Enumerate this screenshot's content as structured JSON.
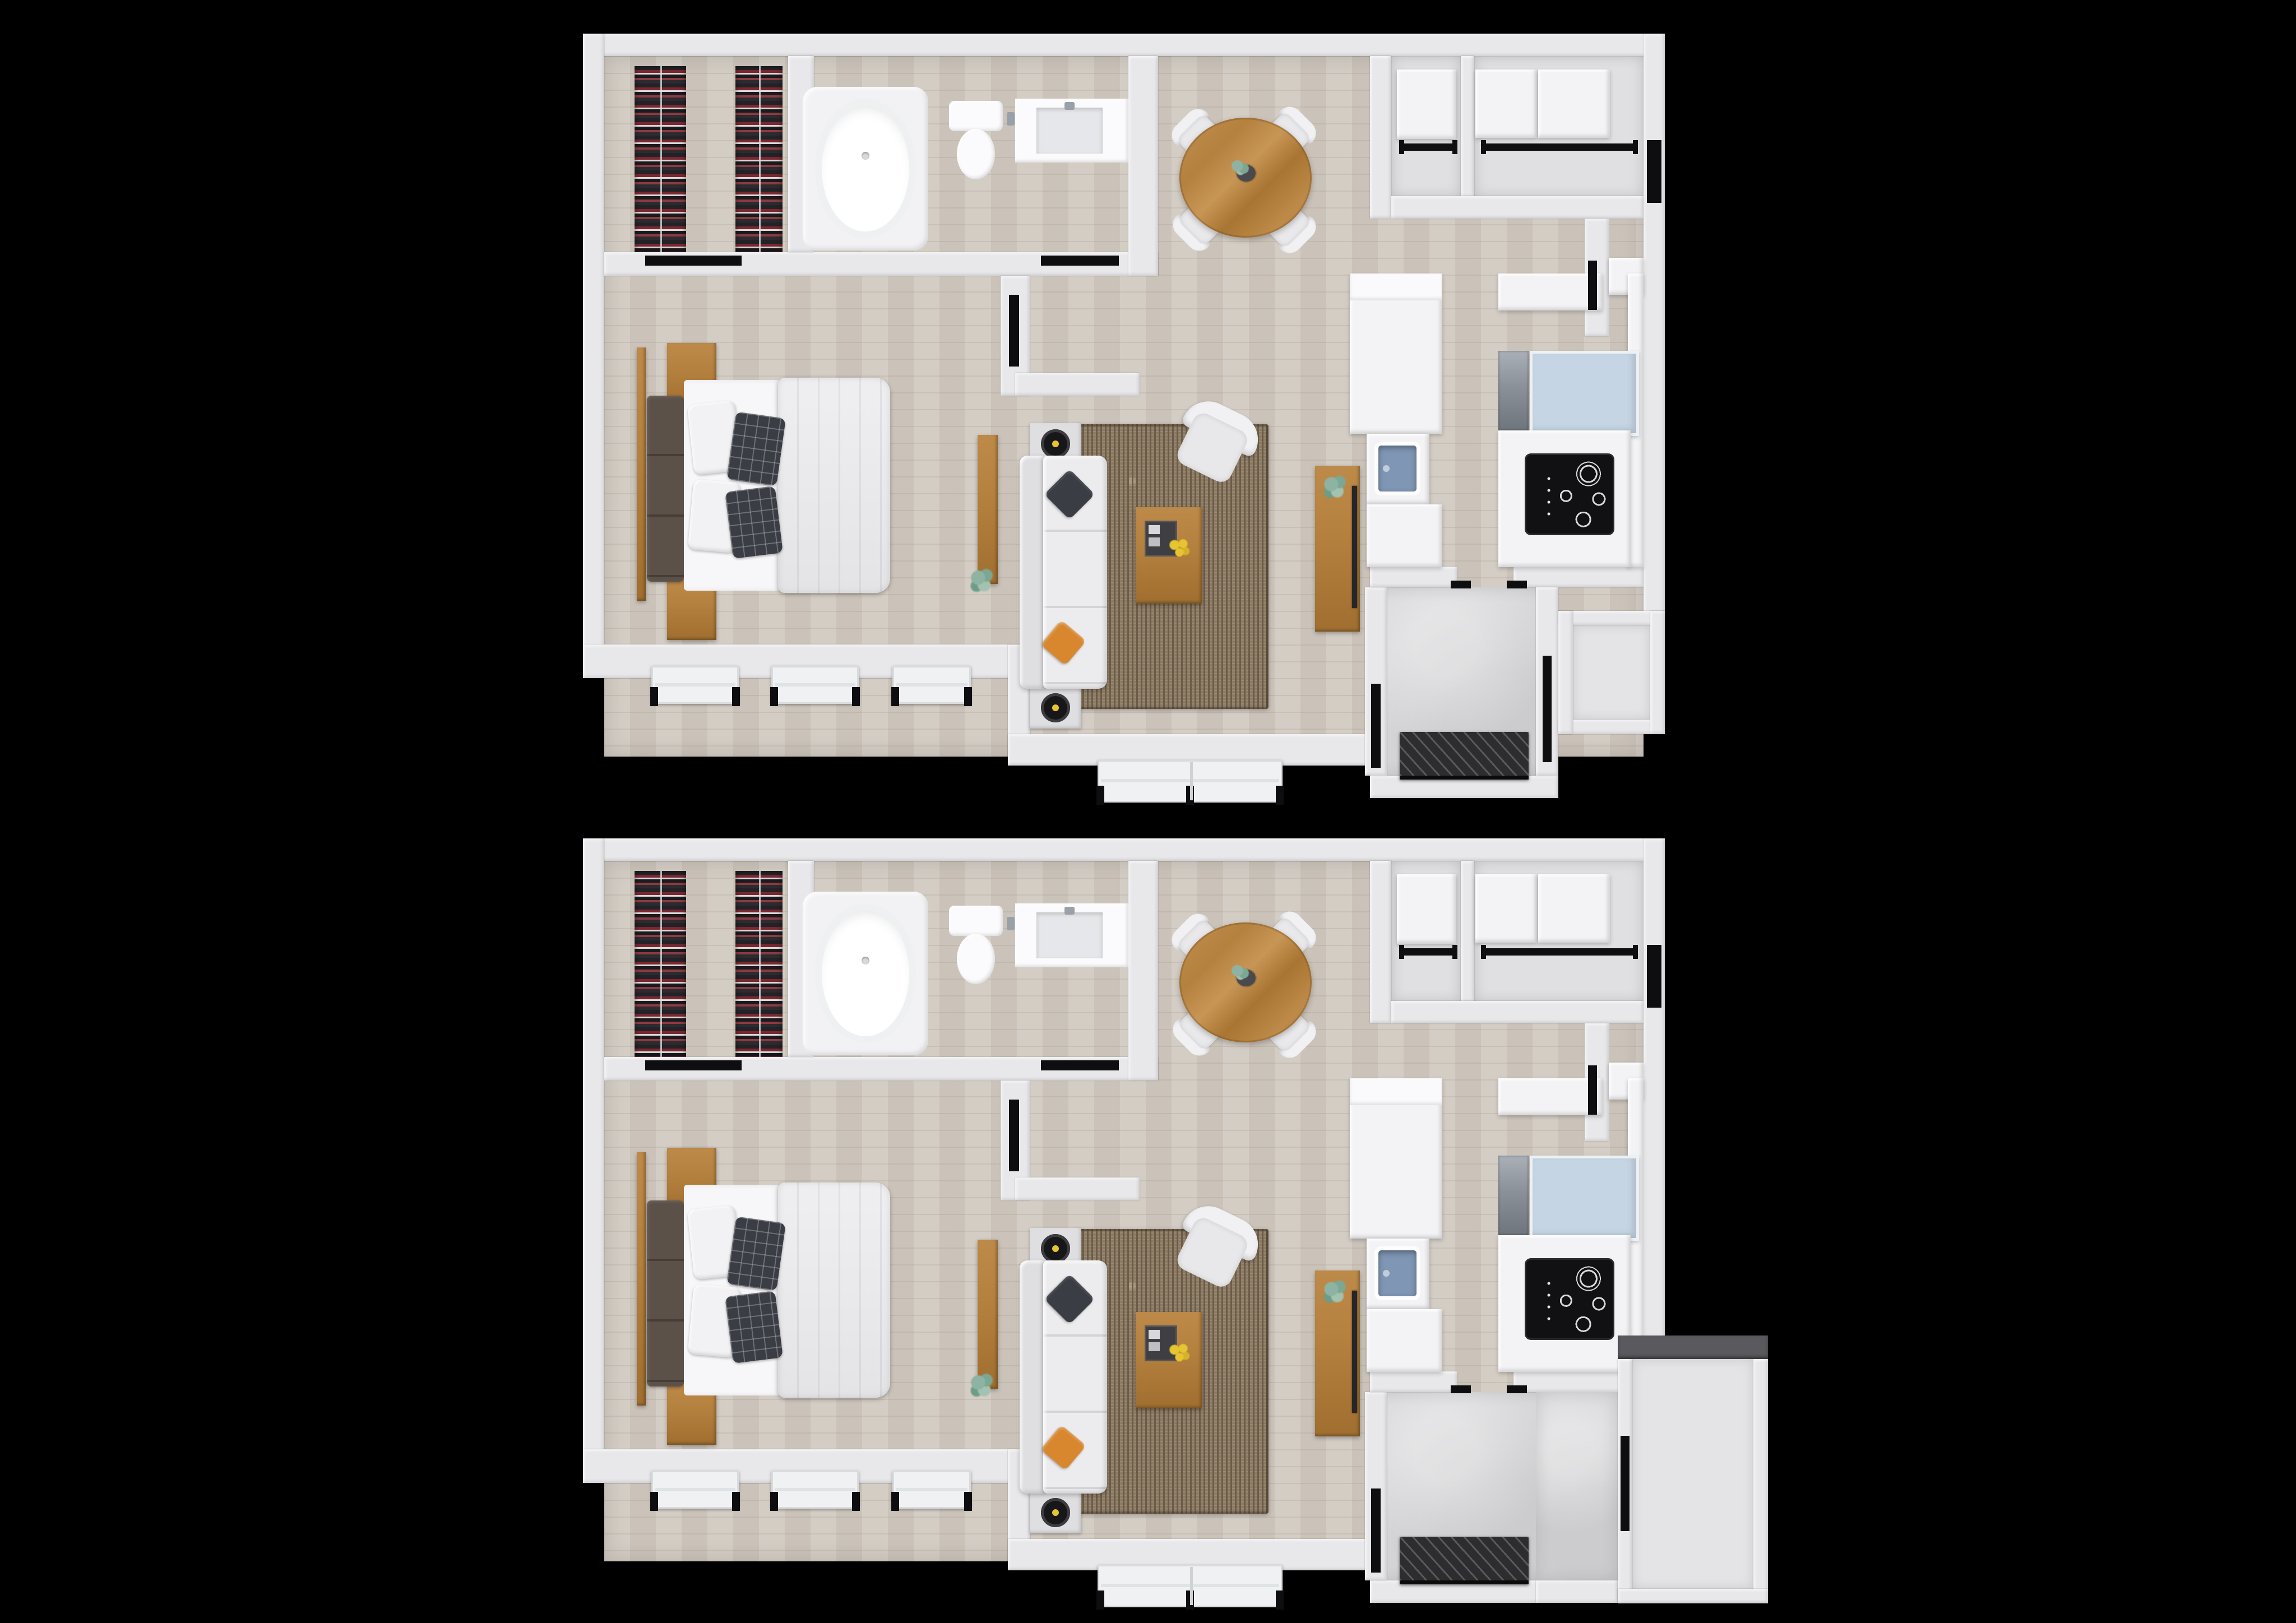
{
  "page": {
    "background_color": "#000000",
    "description": "Two nearly identical 3D-rendered one-bedroom apartment floor plans, stacked vertically on a black background"
  },
  "floorplans": [
    {
      "id": "floor-plan-top",
      "variant": "A",
      "patio_extension": false,
      "rooms": [
        "closet",
        "bathroom",
        "bedroom",
        "hallway",
        "living-room",
        "dining-area",
        "kitchen",
        "entry",
        "porch"
      ]
    },
    {
      "id": "floor-plan-bottom",
      "variant": "B",
      "patio_extension": true,
      "rooms": [
        "closet",
        "bathroom",
        "bedroom",
        "hallway",
        "living-room",
        "dining-area",
        "kitchen",
        "entry",
        "patio"
      ]
    }
  ],
  "furniture_icons": [
    "clothes-rack",
    "bathtub",
    "toilet",
    "vanity-sink",
    "bed",
    "nightstand",
    "dresser-bench",
    "dining-table",
    "dining-chair",
    "sofa",
    "throw-pillow",
    "end-table",
    "coffee-table",
    "armchair",
    "tv-console",
    "area-rug",
    "kitchen-island",
    "island-sink",
    "cooktop",
    "dishwasher",
    "refrigerator",
    "cabinet",
    "storage-box",
    "closet-rod",
    "doormat",
    "door-marker",
    "window-unit",
    "plant"
  ],
  "palette": {
    "background": "#000000",
    "wall": "#e8e8eb",
    "wall_shade": "#d2d2d6",
    "floor_wood": "#d1cac1",
    "floor_wood_line": "#bbb3a8",
    "floor_entry": "#d7d7d9",
    "floor_porch": "#e4e4e6",
    "niche_floor": "#e0e0e3",
    "rug": "#8b7a63",
    "rug_rib": "#6c5c47",
    "rug_fleck": "#a8967d",
    "sofa": "#ececee",
    "furniture_white": "#f3f3f5",
    "wood": "#b5813f",
    "wood_dark": "#936427",
    "duvet": "#e9e9eb",
    "pillow_dark": "#3a3d44",
    "headboard": "#5c5149",
    "orange": "#d8872e",
    "yellow": "#e6c531",
    "plant_green": "#8fb3a2",
    "sink_blue": "#7f96b4",
    "fridge_blue": "#c6d5e4",
    "steel": "#9aa0a8",
    "marker_black": "#0e0e10",
    "mat_dark": "#2d2d30",
    "clothes_red": "#7c2730",
    "clothes_dark": "#232327",
    "clothes_light": "#d9d9da",
    "tub_white": "#ffffff"
  }
}
